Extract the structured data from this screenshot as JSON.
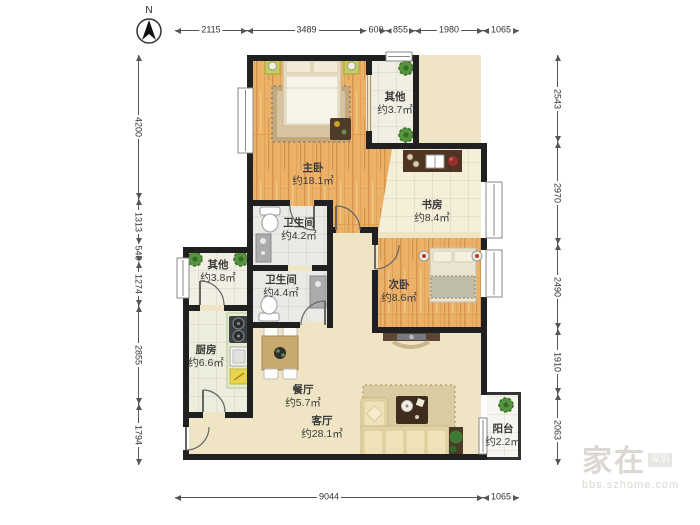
{
  "compass": {
    "label": "N"
  },
  "rooms": {
    "master": {
      "name": "主卧",
      "area": "约18.1㎡"
    },
    "other_top": {
      "name": "其他",
      "area": "约3.7㎡"
    },
    "study": {
      "name": "书房",
      "area": "约8.4㎡"
    },
    "bath_upper": {
      "name": "卫生间",
      "area": "约4.2㎡"
    },
    "other_left": {
      "name": "其他",
      "area": "约3.8㎡"
    },
    "bath_lower": {
      "name": "卫生间",
      "area": "约4.4㎡"
    },
    "bedroom2": {
      "name": "次卧",
      "area": "约8.6㎡"
    },
    "kitchen": {
      "name": "厨房",
      "area": "约6.6㎡"
    },
    "dining": {
      "name": "餐厅",
      "area": "约5.7㎡"
    },
    "living": {
      "name": "客厅",
      "area": "约28.1㎡"
    },
    "balcony": {
      "name": "阳台",
      "area": "约2.2㎡"
    }
  },
  "dimensions": {
    "top": [
      "2115",
      "3489",
      "600",
      "855",
      "1980",
      "1065"
    ],
    "bottom": [
      "9044",
      "1065"
    ],
    "left": [
      "4200",
      "1313",
      "540",
      "1274",
      "2855",
      "1794"
    ],
    "right": [
      "2543",
      "2970",
      "2490",
      "1910",
      "2063"
    ]
  },
  "watermark": {
    "main": "家在",
    "badge": "深圳",
    "url": "bbs.szhome.com"
  },
  "colors": {
    "wall": "#202020",
    "wood_floor": "#ECB169",
    "cream_floor": "#EFE5C4",
    "tile_floor": "#F0EEE3",
    "dim_line": "#555555"
  }
}
